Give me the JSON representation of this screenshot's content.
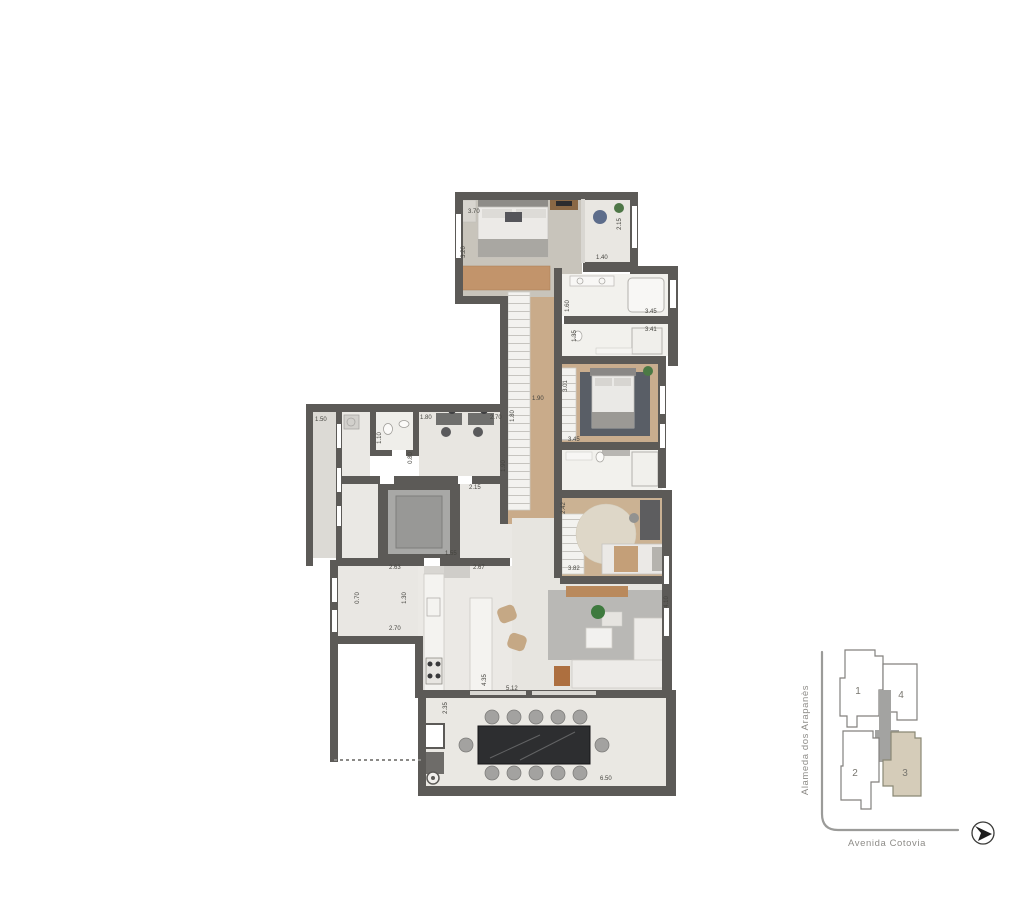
{
  "plan": {
    "dimension_labels": [
      {
        "text": "3.70"
      },
      {
        "text": "3.20"
      },
      {
        "text": "2.15"
      },
      {
        "text": "1.40"
      },
      {
        "text": "1.60"
      },
      {
        "text": "3.45"
      },
      {
        "text": "3.41"
      },
      {
        "text": "1.35"
      },
      {
        "text": "1.90"
      },
      {
        "text": "1.80"
      },
      {
        "text": "3.01"
      },
      {
        "text": "3.45"
      },
      {
        "text": "2.42"
      },
      {
        "text": "3.82"
      },
      {
        "text": "4.10"
      },
      {
        "text": "1.50"
      },
      {
        "text": "1.10"
      },
      {
        "text": "1.80"
      },
      {
        "text": "2.70"
      },
      {
        "text": "1.90"
      },
      {
        "text": "0.80"
      },
      {
        "text": "2.15"
      },
      {
        "text": "1.55"
      },
      {
        "text": "2.63"
      },
      {
        "text": "2.67"
      },
      {
        "text": "0.70"
      },
      {
        "text": "1.30"
      },
      {
        "text": "2.70"
      },
      {
        "text": "4.35"
      },
      {
        "text": "5.12"
      },
      {
        "text": "2.35"
      },
      {
        "text": "6.50"
      }
    ]
  },
  "key_map": {
    "street_vertical": "Alameda dos Arapanès",
    "street_horizontal": "Avenida Cotovia",
    "units": [
      {
        "number": "1",
        "highlighted": false
      },
      {
        "number": "2",
        "highlighted": false
      },
      {
        "number": "3",
        "highlighted": true
      },
      {
        "number": "4",
        "highlighted": false
      }
    ],
    "highlight_color": "#d5ccb9",
    "core_color": "#a3a3a1"
  },
  "colors": {
    "wall": "#5c5a57",
    "wood_floor": "#c9ab8a",
    "marble_floor": "#f2f1ed",
    "stone_floor": "#e8e6e1",
    "living_rug": "#b9b8b5",
    "suite_rug": "#595e66",
    "terrace_table": "#2d2e30"
  }
}
